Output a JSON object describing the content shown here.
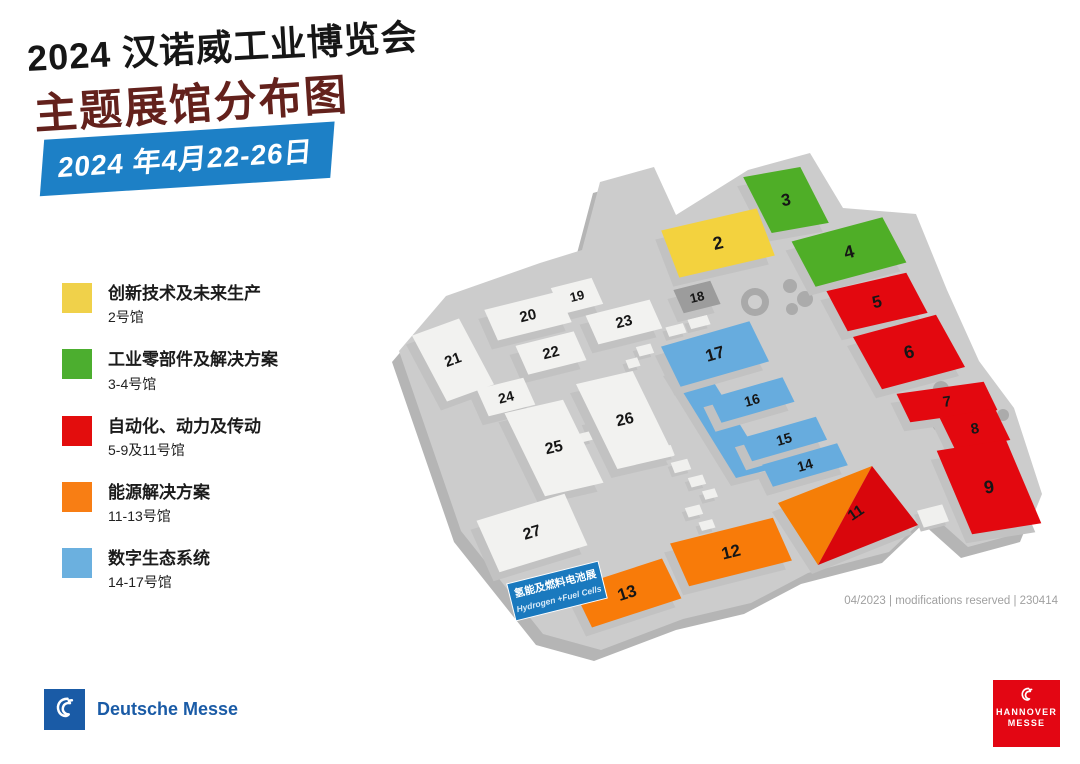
{
  "header": {
    "title": "2024 汉诺威工业博览会",
    "subtitle": "主题展馆分布图",
    "date_banner": "2024 年4月22-26日",
    "banner_color": "#1D80C6",
    "subtitle_color": "#63211C"
  },
  "legend": {
    "items": [
      {
        "label": "创新技术及未来生产",
        "halls": "2号馆",
        "color": "#F0D14A"
      },
      {
        "label": "工业零部件及解决方案",
        "halls": "3-4号馆",
        "color": "#4CAE2F"
      },
      {
        "label": "自动化、动力及传动",
        "halls": "5-9及11号馆",
        "color": "#E30D0D"
      },
      {
        "label": "能源解决方案",
        "halls": "11-13号馆",
        "color": "#F87E14"
      },
      {
        "label": "数字生态系统",
        "halls": "14-17号馆",
        "color": "#6BB0DF"
      }
    ]
  },
  "map": {
    "footnote": "04/2023 | modifications reserved | 230414",
    "colors": {
      "plate": "#CCCCCC",
      "plate_side": "#B5B5B5",
      "plinth": "#C2C2C2",
      "pyramid_orange": "#F57E07",
      "pyramid_red": "#D9060C",
      "palette": {
        "yellow": "#F3D23E",
        "green": "#4FAE27",
        "red": "#E3080F",
        "orange": "#F87B09",
        "blue": "#67ACDE",
        "white": "#F2F2F0",
        "dark": "#9C9C9C"
      }
    },
    "plate": [
      [
        600,
        182
      ],
      [
        654,
        167
      ],
      [
        676,
        215
      ],
      [
        748,
        170
      ],
      [
        810,
        153
      ],
      [
        843,
        208
      ],
      [
        916,
        214
      ],
      [
        947,
        290
      ],
      [
        979,
        361
      ],
      [
        1014,
        408
      ],
      [
        1042,
        494
      ],
      [
        1027,
        531
      ],
      [
        968,
        547
      ],
      [
        930,
        513
      ],
      [
        889,
        552
      ],
      [
        808,
        573
      ],
      [
        751,
        603
      ],
      [
        683,
        619
      ],
      [
        601,
        650
      ],
      [
        543,
        634
      ],
      [
        461,
        531
      ],
      [
        399,
        351
      ],
      [
        446,
        296
      ],
      [
        540,
        263
      ],
      [
        582,
        250
      ]
    ],
    "spine": [
      [
        668,
        368
      ],
      [
        700,
        360
      ],
      [
        768,
        470
      ],
      [
        736,
        478
      ]
    ],
    "halls": [
      {
        "n": "3",
        "c": "green",
        "cx": 786,
        "cy": 200,
        "w": 58,
        "h": 60,
        "rot": -10,
        "skew": 17,
        "fs": 17
      },
      {
        "n": "2",
        "c": "yellow",
        "cx": 718,
        "cy": 243,
        "w": 98,
        "h": 50,
        "rot": -13,
        "skew": 8,
        "fs": 18
      },
      {
        "n": "4",
        "c": "green",
        "cx": 849,
        "cy": 252,
        "w": 94,
        "h": 50,
        "rot": -15,
        "skew": 13,
        "fs": 18
      },
      {
        "n": "5",
        "c": "red",
        "cx": 877,
        "cy": 302,
        "w": 82,
        "h": 44,
        "rot": -13,
        "skew": 15,
        "fs": 17
      },
      {
        "n": "6",
        "c": "red",
        "cx": 909,
        "cy": 352,
        "w": 86,
        "h": 58,
        "rot": -15,
        "skew": 14,
        "fs": 18
      },
      {
        "n": "7",
        "c": "red",
        "cx": 947,
        "cy": 402,
        "w": 88,
        "h": 30,
        "rot": -8,
        "skew": 18,
        "fs": 15
      },
      {
        "n": "8",
        "c": "red",
        "cx": 975,
        "cy": 429,
        "w": 56,
        "h": 34,
        "rot": -10,
        "skew": 16,
        "fs": 15
      },
      {
        "n": "9",
        "c": "red",
        "cx": 989,
        "cy": 487,
        "w": 70,
        "h": 88,
        "rot": -9,
        "skew": 14,
        "fs": 18
      },
      {
        "n": "19",
        "c": "white",
        "cx": 577,
        "cy": 296,
        "w": 42,
        "h": 28,
        "rot": -14,
        "skew": 10,
        "fs": 13
      },
      {
        "n": "20",
        "c": "white",
        "cx": 528,
        "cy": 316,
        "w": 76,
        "h": 33,
        "rot": -14,
        "skew": 10,
        "fs": 15
      },
      {
        "n": "18",
        "c": "dark",
        "cx": 697,
        "cy": 297,
        "w": 38,
        "h": 25,
        "rot": -14,
        "skew": 10,
        "fs": 13
      },
      {
        "n": "23",
        "c": "white",
        "cx": 624,
        "cy": 322,
        "w": 66,
        "h": 31,
        "rot": -14,
        "skew": 10,
        "fs": 15
      },
      {
        "n": "22",
        "c": "white",
        "cx": 551,
        "cy": 353,
        "w": 60,
        "h": 31,
        "rot": -14,
        "skew": 10,
        "fs": 15
      },
      {
        "n": "21",
        "c": "white",
        "cx": 453,
        "cy": 360,
        "w": 50,
        "h": 74,
        "rot": -20,
        "skew": 8,
        "fs": 15
      },
      {
        "n": "24",
        "c": "white",
        "cx": 506,
        "cy": 397,
        "w": 48,
        "h": 29,
        "rot": -14,
        "skew": 10,
        "fs": 14
      },
      {
        "n": "26",
        "c": "white",
        "cx": 625,
        "cy": 420,
        "w": 58,
        "h": 92,
        "rot": -13,
        "skew": 13,
        "fs": 16
      },
      {
        "n": "25",
        "c": "white",
        "cx": 554,
        "cy": 448,
        "w": 60,
        "h": 90,
        "rot": -13,
        "skew": 13,
        "fs": 16
      },
      {
        "n": "17",
        "c": "blue",
        "cx": 715,
        "cy": 354,
        "w": 92,
        "h": 44,
        "rot": -16,
        "skew": 10,
        "fs": 17
      },
      {
        "n": "16",
        "c": "blue",
        "cx": 752,
        "cy": 400,
        "w": 76,
        "h": 27,
        "rot": -16,
        "skew": 10,
        "fs": 14
      },
      {
        "n": "15",
        "c": "blue",
        "cx": 784,
        "cy": 439,
        "w": 78,
        "h": 25,
        "rot": -16,
        "skew": 10,
        "fs": 14
      },
      {
        "n": "14",
        "c": "blue",
        "cx": 805,
        "cy": 465,
        "w": 78,
        "h": 24,
        "rot": -16,
        "skew": 10,
        "fs": 14
      },
      {
        "n": "27",
        "c": "white",
        "cx": 532,
        "cy": 533,
        "w": 92,
        "h": 56,
        "rot": -17,
        "skew": 7,
        "fs": 16
      },
      {
        "n": "12",
        "c": "orange",
        "cx": 731,
        "cy": 552,
        "w": 106,
        "h": 46,
        "rot": -14,
        "skew": 10,
        "fs": 17
      },
      {
        "n": "13",
        "c": "orange",
        "cx": 627,
        "cy": 593,
        "w": 94,
        "h": 44,
        "rot": -18,
        "skew": 8,
        "fs": 17
      }
    ],
    "pyramid": {
      "label": "11",
      "n": [
        872,
        466
      ],
      "e": [
        918,
        525
      ],
      "s": [
        818,
        565
      ],
      "w": [
        778,
        503
      ],
      "lx": 856,
      "ly": 513,
      "lrot": -34,
      "fs": 15
    },
    "tag": {
      "x": 557,
      "y": 591,
      "rot": -14,
      "w": 94,
      "h": 38,
      "bg": "#1A79BE",
      "line1": "氢能及燃料电池展",
      "line2": "Hydrogen +Fuel Cells"
    },
    "decor_boxes": [
      {
        "cx": 676,
        "cy": 330,
        "w": 18,
        "h": 10
      },
      {
        "cx": 699,
        "cy": 322,
        "w": 20,
        "h": 10
      },
      {
        "cx": 645,
        "cy": 350,
        "w": 15,
        "h": 10
      },
      {
        "cx": 633,
        "cy": 363,
        "w": 12,
        "h": 9
      },
      {
        "cx": 597,
        "cy": 425,
        "w": 20,
        "h": 13
      },
      {
        "cx": 585,
        "cy": 437,
        "w": 13,
        "h": 9
      },
      {
        "cx": 665,
        "cy": 452,
        "w": 16,
        "h": 11
      },
      {
        "cx": 681,
        "cy": 466,
        "w": 17,
        "h": 11
      },
      {
        "cx": 697,
        "cy": 481,
        "w": 15,
        "h": 10
      },
      {
        "cx": 710,
        "cy": 494,
        "w": 13,
        "h": 9
      },
      {
        "cx": 694,
        "cy": 511,
        "w": 15,
        "h": 10
      },
      {
        "cx": 707,
        "cy": 525,
        "w": 14,
        "h": 9
      },
      {
        "cx": 933,
        "cy": 516,
        "w": 26,
        "h": 18
      }
    ],
    "trees": [
      {
        "x": 755,
        "y": 302,
        "r": 14,
        "f": "#A9A9A9"
      },
      {
        "x": 755,
        "y": 302,
        "r": 7,
        "f": "#CFCFCF"
      },
      {
        "x": 790,
        "y": 286,
        "r": 7
      },
      {
        "x": 805,
        "y": 299,
        "r": 8
      },
      {
        "x": 792,
        "y": 309,
        "r": 6
      },
      {
        "x": 852,
        "y": 302,
        "r": 7
      },
      {
        "x": 868,
        "y": 314,
        "r": 8
      },
      {
        "x": 856,
        "y": 325,
        "r": 6
      },
      {
        "x": 941,
        "y": 389,
        "r": 8
      },
      {
        "x": 959,
        "y": 398,
        "r": 9
      },
      {
        "x": 948,
        "y": 412,
        "r": 7
      },
      {
        "x": 973,
        "y": 408,
        "r": 8
      },
      {
        "x": 962,
        "y": 424,
        "r": 8
      },
      {
        "x": 986,
        "y": 428,
        "r": 7
      },
      {
        "x": 951,
        "y": 440,
        "r": 6
      },
      {
        "x": 996,
        "y": 446,
        "r": 7
      },
      {
        "x": 1003,
        "y": 415,
        "r": 6
      },
      {
        "x": 938,
        "y": 426,
        "r": 5
      }
    ]
  },
  "footer": {
    "deutsche_messe": "Deutsche Messe",
    "hannover_line1": "HANNOVER",
    "hannover_line2": "MESSE",
    "dm_blue": "#1A5BA6",
    "hm_red": "#E30613"
  }
}
